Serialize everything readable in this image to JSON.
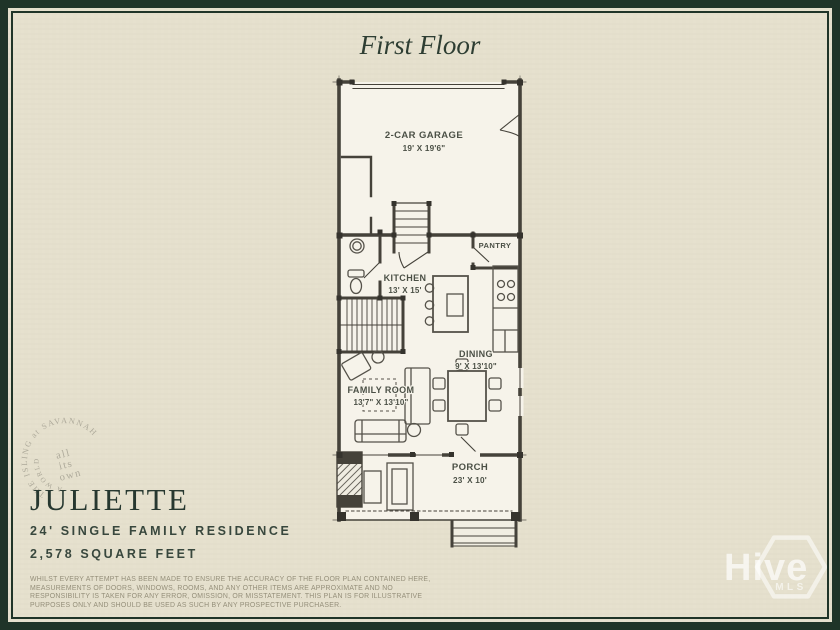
{
  "header": {
    "title": "First Floor"
  },
  "info": {
    "plan_name": "JULIETTE",
    "line1": "24' SINGLE FAMILY RESIDENCE",
    "line2": "2,578 SQUARE FEET"
  },
  "rooms": [
    {
      "id": "garage",
      "name": "2-CAR GARAGE",
      "dims": "19' X 19'6\""
    },
    {
      "id": "pantry",
      "name": "PANTRY",
      "dims": ""
    },
    {
      "id": "kitchen",
      "name": "KITCHEN",
      "dims": "13' X 15'"
    },
    {
      "id": "dining",
      "name": "DINING",
      "dims": "9' X 13'10\""
    },
    {
      "id": "family",
      "name": "FAMILY ROOM",
      "dims": "13'7\" X 13'10\""
    },
    {
      "id": "porch",
      "name": "PORCH",
      "dims": "23' X 10'"
    }
  ],
  "stamp": {
    "arc_outer": "THE ISLING at SAVANNAH",
    "arc_inner": "A WORLD",
    "center_line1": "all",
    "center_line2": "its",
    "center_line3": "own"
  },
  "watermark": {
    "brand": "Hive",
    "sub": "MLS"
  },
  "disclaimer": "WHILST EVERY ATTEMPT HAS BEEN MADE TO ENSURE THE ACCURACY OF THE FLOOR PLAN CONTAINED HERE, MEASUREMENTS OF DOORS, WINDOWS, ROOMS, AND ANY OTHER ITEMS ARE APPROXIMATE AND NO RESPONSIBILITY IS TAKEN FOR ANY ERROR, OMISSION, OR MISSTATEMENT. THIS PLAN IS FOR ILLUSTRATIVE PURPOSES ONLY AND SHOULD BE USED AS SUCH BY ANY PROSPECTIVE PURCHASER.",
  "colors": {
    "frame_green": "#1f3428",
    "background_beige": "#e5e0cd",
    "plan_paper": "#f6f3ea",
    "ink": "#45423a",
    "heading_green": "#2e3e33",
    "stamp_gray": "#a8a495",
    "watermark_white": "#ffffff"
  }
}
